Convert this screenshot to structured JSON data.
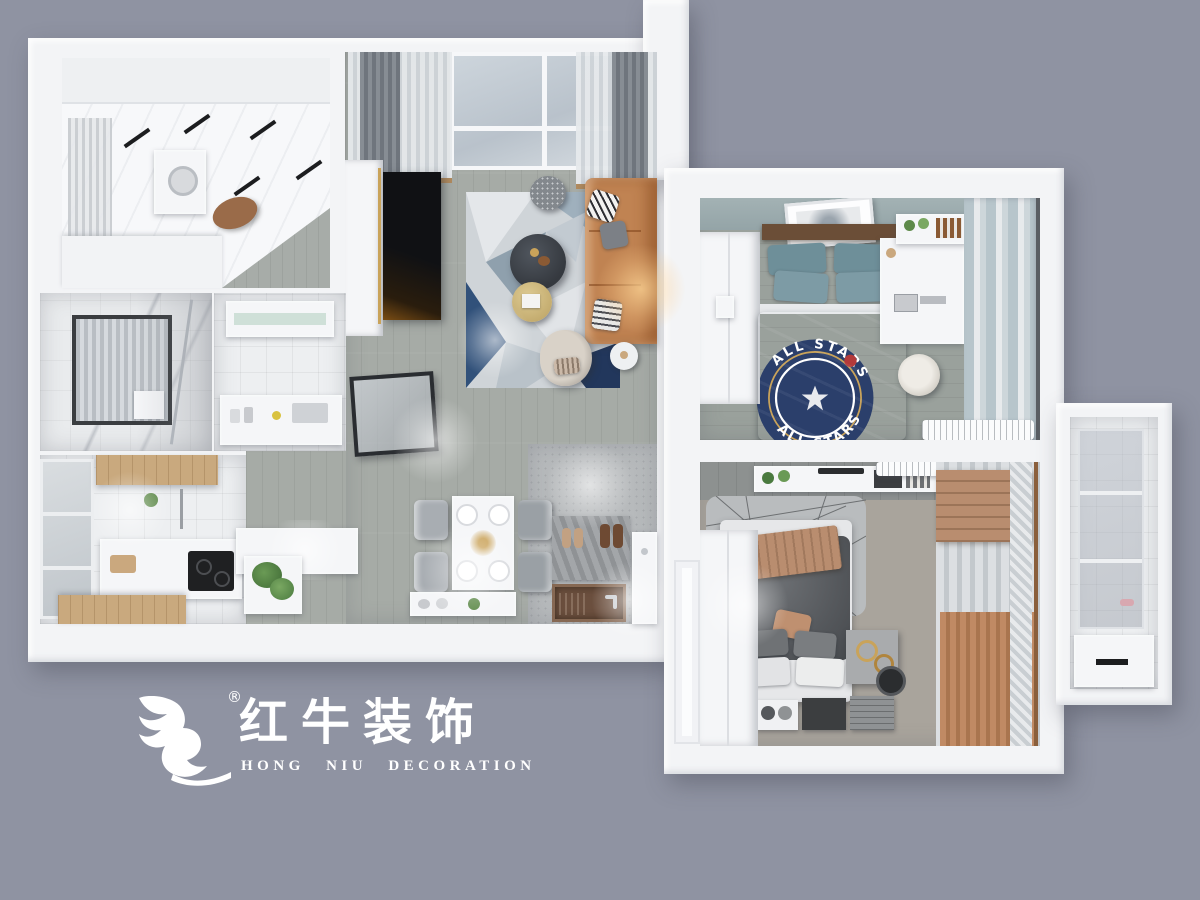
{
  "colors": {
    "bg": "#8f93a2",
    "wall": "#f3f4f6",
    "floor-wood": "#a6aba6",
    "floor-bed2": "#9aa19c",
    "floor-bed1": "#a9a49c",
    "floor-entry": "#b7babc",
    "tile": "#edeff1",
    "sofa": "#c08352",
    "teal": "#48646e",
    "teal-pillow": "#6e8f99",
    "navy": "#2b3f6b",
    "gray-duvet": "#56595d",
    "tan": "#b98d6f",
    "wood": "#c9a97e",
    "white": "#ffffff"
  },
  "logo": {
    "icon": "bull-swoosh-icon",
    "registered": "®",
    "brand_cn": "红牛装饰",
    "brand_en": "HONG NIU DECORATION"
  },
  "rug_badge": {
    "arc_top": "ALL STARS",
    "arc_bottom": "ALL STARS"
  },
  "rooms": [
    "utility-room",
    "living-room",
    "bathroom",
    "kitchen",
    "dining-area",
    "entry-hall",
    "bedroom-teal",
    "bedroom-master",
    "balcony-shower"
  ]
}
